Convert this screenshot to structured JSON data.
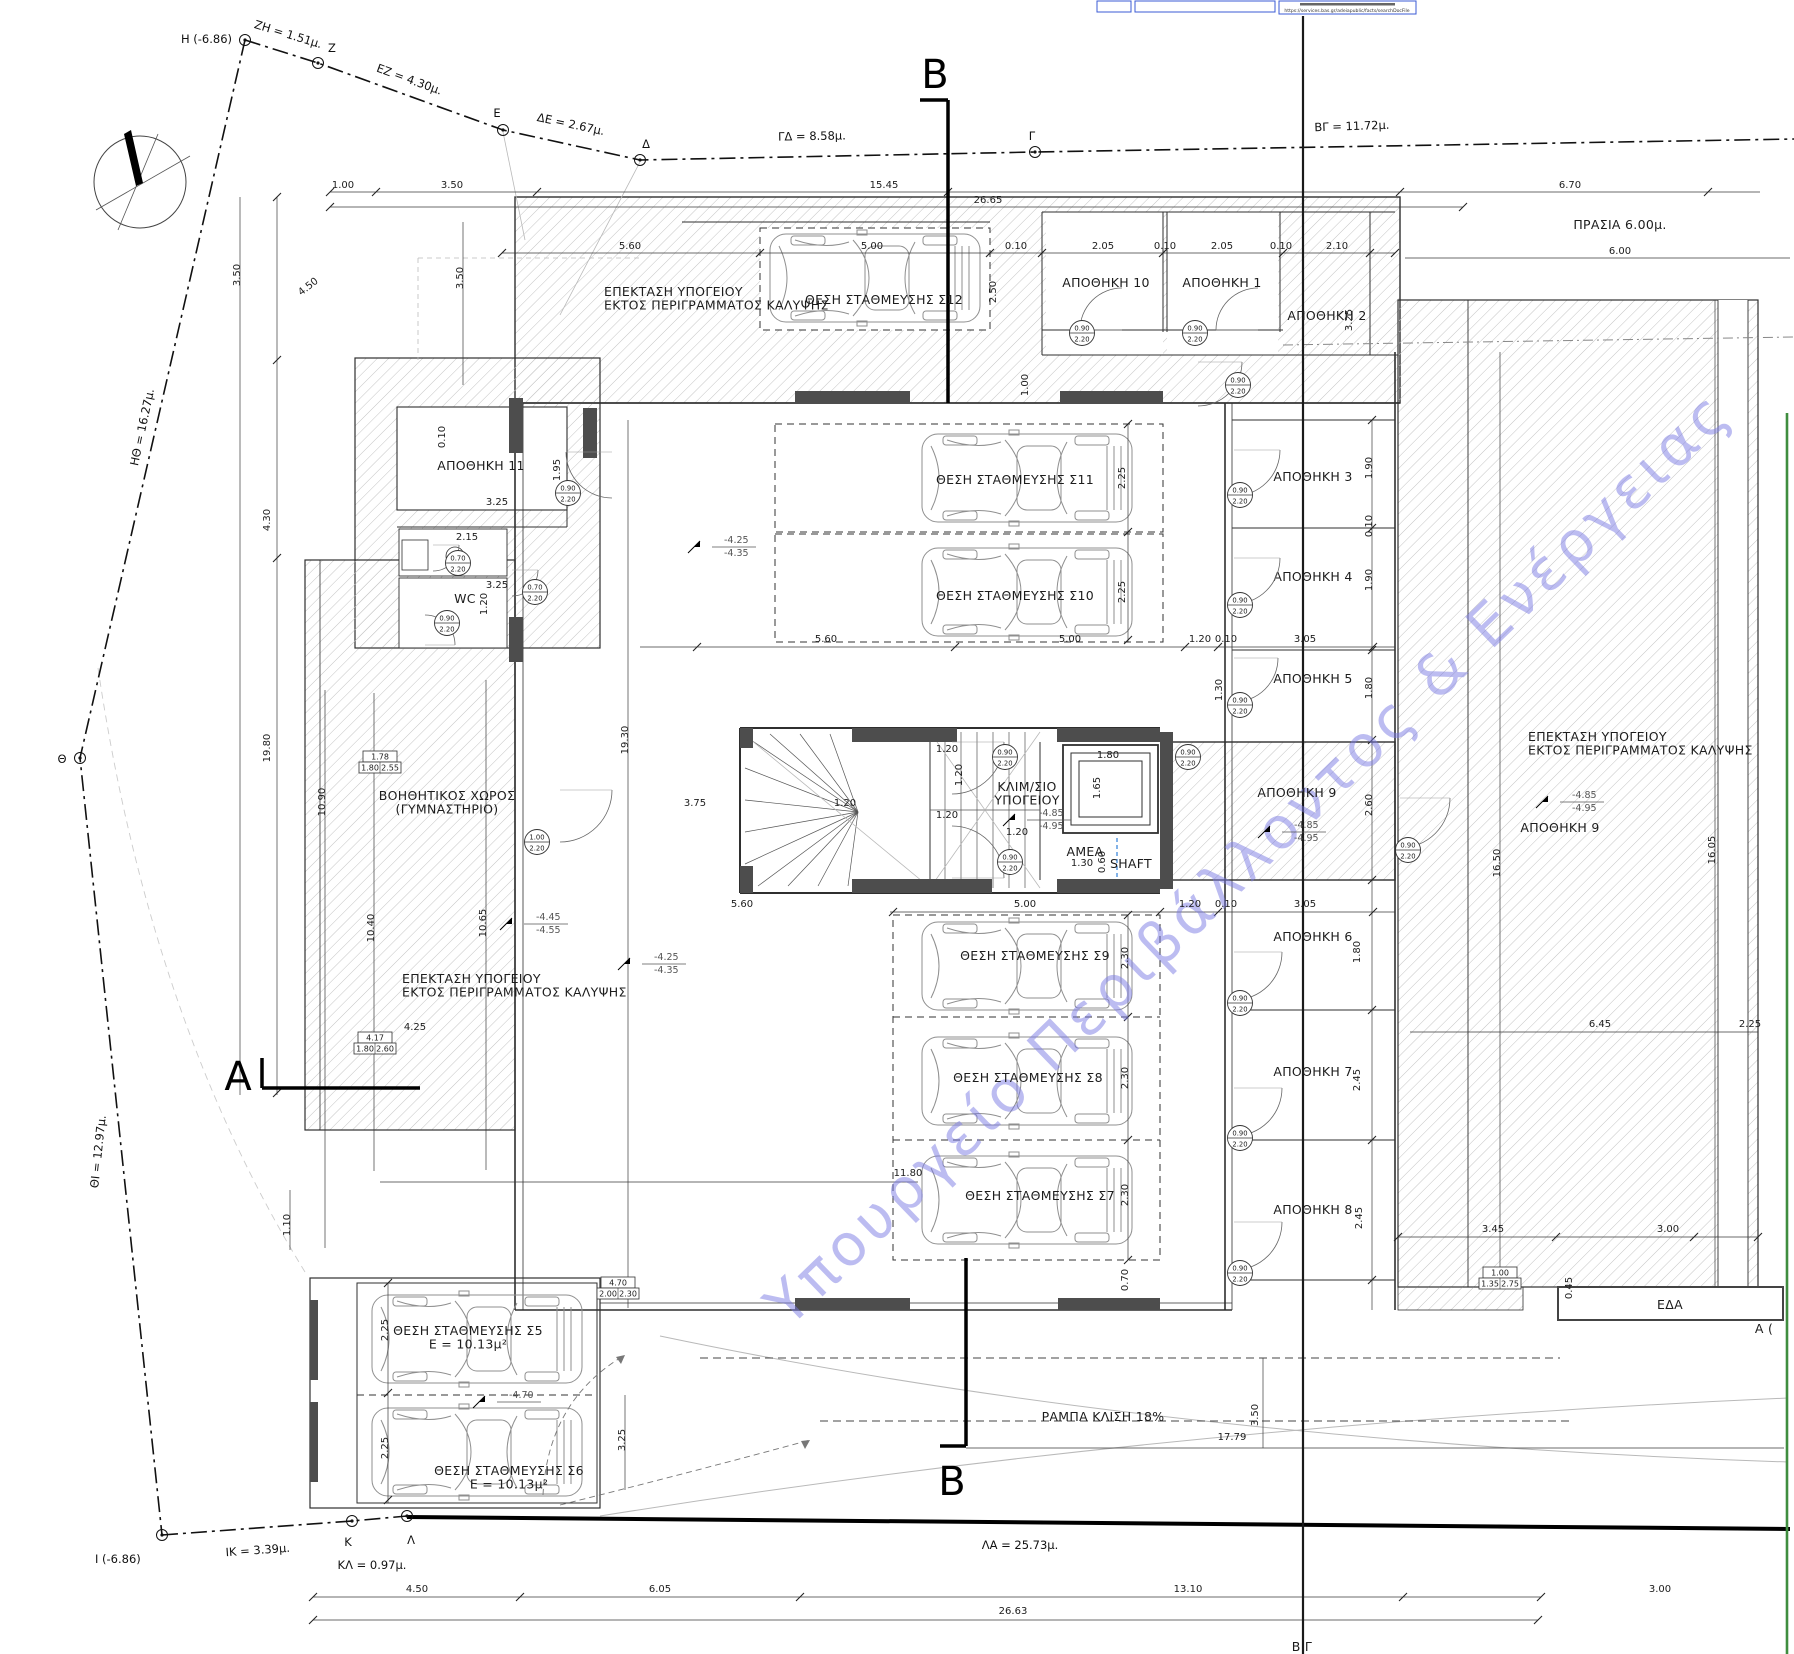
{
  "drawing": {
    "watermark": "Υπουργείο Περιβάλλοντος & Ενέργειας",
    "stamp_url": "https://services.bas.gr/adeiapublic/facts/searchDocFile",
    "accent_blue": "#2e7fd9",
    "green_line_color": "#3f8d3f"
  },
  "boundary": {
    "points": [
      {
        "label": "H (-6.86)",
        "x": 245,
        "y": 40,
        "lx": 232,
        "ly": 43,
        "anchor": "end"
      },
      {
        "label": "Z",
        "x": 318,
        "y": 63,
        "lx": 328,
        "ly": 52,
        "anchor": "start"
      },
      {
        "label": "E",
        "x": 503,
        "y": 130,
        "lx": 497,
        "ly": 117,
        "anchor": "middle"
      },
      {
        "label": "Δ",
        "x": 640,
        "y": 160,
        "lx": 646,
        "ly": 148,
        "anchor": "middle"
      },
      {
        "label": "Γ",
        "x": 1035,
        "y": 152,
        "lx": 1032,
        "ly": 140,
        "anchor": "middle"
      },
      {
        "label": "Θ",
        "x": 80,
        "y": 758,
        "lx": 62,
        "ly": 763,
        "anchor": "middle"
      },
      {
        "label": "Ι (-6.86)",
        "x": 162,
        "y": 1535,
        "lx": 95,
        "ly": 1563,
        "anchor": "start"
      },
      {
        "label": "Κ",
        "x": 352,
        "y": 1521,
        "lx": 348,
        "ly": 1546,
        "anchor": "middle"
      },
      {
        "label": "Λ",
        "x": 407,
        "y": 1516,
        "lx": 411,
        "ly": 1544,
        "anchor": "middle"
      }
    ],
    "segments": [
      {
        "label": "ZH = 1.51μ.",
        "x": 287,
        "y": 38,
        "rot": 17
      },
      {
        "label": "EZ = 4.30μ.",
        "x": 408,
        "y": 83,
        "rot": 20
      },
      {
        "label": "ΔΕ = 2.67μ.",
        "x": 570,
        "y": 128,
        "rot": 12
      },
      {
        "label": "ΓΔ = 8.58μ.",
        "x": 812,
        "y": 140,
        "rot": -1
      },
      {
        "label": "ΒΓ = 11.72μ.",
        "x": 1352,
        "y": 130,
        "rot": -2
      },
      {
        "label": "ΗΘ = 16.27μ.",
        "x": 146,
        "y": 428,
        "rot": -78
      },
      {
        "label": "ΘΙ = 12.97μ.",
        "x": 102,
        "y": 1152,
        "rot": -84
      },
      {
        "label": "ΙΚ = 3.39μ.",
        "x": 258,
        "y": 1554,
        "rot": -4
      },
      {
        "label": "ΚΛ = 0.97μ.",
        "x": 372,
        "y": 1569,
        "rot": 0
      },
      {
        "label": "ΛΑ = 25.73μ.",
        "x": 1020,
        "y": 1549,
        "rot": 0
      }
    ]
  },
  "sections": [
    {
      "letter": "Β",
      "x": 935,
      "y": 88,
      "size": 40
    },
    {
      "letter": "Β",
      "x": 952,
      "y": 1495,
      "size": 40
    },
    {
      "letter": "Α",
      "x": 238,
      "y": 1090,
      "size": 38
    }
  ],
  "room_labels": [
    {
      "id": "epektasi-top",
      "lines": [
        "ΕΠΕΚΤΑΣΗ ΥΠΟΓΕΙΟΥ",
        "ΕΚΤΟΣ ΠΕΡΙΓΡΑΜΜΑΤΟΣ ΚΑΛΥΨΗΣ"
      ],
      "x": 604,
      "y": 296,
      "align": "start"
    },
    {
      "id": "parking-s12",
      "lines": [
        "ΘΕΣΗ ΣΤΑΘΜΕΥΣΗΣ Σ12"
      ],
      "x": 884,
      "y": 304
    },
    {
      "id": "apothiki-10",
      "lines": [
        "ΑΠΟΘΗΚΗ 10"
      ],
      "x": 1106,
      "y": 287
    },
    {
      "id": "apothiki-1",
      "lines": [
        "ΑΠΟΘΗΚΗ 1"
      ],
      "x": 1222,
      "y": 287
    },
    {
      "id": "apothiki-2",
      "lines": [
        "ΑΠΟΘΗΚΗ 2"
      ],
      "x": 1327,
      "y": 320
    },
    {
      "id": "apothiki-11",
      "lines": [
        "ΑΠΟΘΗΚΗ 11"
      ],
      "x": 481,
      "y": 470
    },
    {
      "id": "wc",
      "lines": [
        "WC"
      ],
      "x": 465,
      "y": 603
    },
    {
      "id": "parking-s11",
      "lines": [
        "ΘΕΣΗ ΣΤΑΘΜΕΥΣΗΣ Σ11"
      ],
      "x": 1015,
      "y": 484
    },
    {
      "id": "parking-s10",
      "lines": [
        "ΘΕΣΗ ΣΤΑΘΜΕΥΣΗΣ Σ10"
      ],
      "x": 1015,
      "y": 600
    },
    {
      "id": "apothiki-3",
      "lines": [
        "ΑΠΟΘΗΚΗ 3"
      ],
      "x": 1313,
      "y": 481
    },
    {
      "id": "apothiki-4",
      "lines": [
        "ΑΠΟΘΗΚΗ 4"
      ],
      "x": 1313,
      "y": 581
    },
    {
      "id": "apothiki-5",
      "lines": [
        "ΑΠΟΘΗΚΗ 5"
      ],
      "x": 1313,
      "y": 683
    },
    {
      "id": "klimakostasio",
      "lines": [
        "ΚΛΙΜ/ΣΙΟ",
        "ΥΠΟΓΕΙΟΥ"
      ],
      "x": 1027,
      "y": 791
    },
    {
      "id": "amea",
      "lines": [
        "ΑΜΕΑ"
      ],
      "x": 1085,
      "y": 856,
      "size": 15,
      "color": "#2e7fd9"
    },
    {
      "id": "shaft",
      "lines": [
        "SHAFT"
      ],
      "x": 1131,
      "y": 868
    },
    {
      "id": "apothiki-9-core",
      "lines": [
        "ΑΠΟΘΗΚΗ 9"
      ],
      "x": 1297,
      "y": 797
    },
    {
      "id": "gym",
      "lines": [
        "ΒΟΗΘΗΤΙΚΟΣ ΧΩΡΟΣ",
        "(ΓΥΜΝΑΣΤΗΡΙΟ)"
      ],
      "x": 447,
      "y": 800
    },
    {
      "id": "epektasi-left",
      "lines": [
        "ΕΠΕΚΤΑΣΗ ΥΠΟΓΕΙΟΥ",
        "ΕΚΤΟΣ ΠΕΡΙΓΡΑΜΜΑΤΟΣ ΚΑΛΥΨΗΣ"
      ],
      "x": 402,
      "y": 983,
      "align": "start"
    },
    {
      "id": "parking-s9",
      "lines": [
        "ΘΕΣΗ ΣΤΑΘΜΕΥΣΗΣ Σ9"
      ],
      "x": 1035,
      "y": 960
    },
    {
      "id": "parking-s8",
      "lines": [
        "ΘΕΣΗ ΣΤΑΘΜΕΥΣΗΣ Σ8"
      ],
      "x": 1028,
      "y": 1082
    },
    {
      "id": "parking-s7",
      "lines": [
        "ΘΕΣΗ ΣΤΑΘΜΕΥΣΗΣ Σ7"
      ],
      "x": 1040,
      "y": 1200
    },
    {
      "id": "apothiki-6",
      "lines": [
        "ΑΠΟΘΗΚΗ 6"
      ],
      "x": 1313,
      "y": 941
    },
    {
      "id": "apothiki-7",
      "lines": [
        "ΑΠΟΘΗΚΗ 7"
      ],
      "x": 1313,
      "y": 1076
    },
    {
      "id": "apothiki-8",
      "lines": [
        "ΑΠΟΘΗΚΗ 8"
      ],
      "x": 1313,
      "y": 1214
    },
    {
      "id": "epektasi-right",
      "lines": [
        "ΕΠΕΚΤΑΣΗ ΥΠΟΓΕΙΟΥ",
        "ΕΚΤΟΣ ΠΕΡΙΓΡΑΜΜΑΤΟΣ ΚΑΛΥΨΗΣ"
      ],
      "x": 1528,
      "y": 741,
      "align": "start"
    },
    {
      "id": "apothiki-9-right",
      "lines": [
        "ΑΠΟΘΗΚΗ 9"
      ],
      "x": 1560,
      "y": 832
    },
    {
      "id": "parking-s5",
      "lines": [
        "ΘΕΣΗ ΣΤΑΘΜΕΥΣΗΣ Σ5",
        "Ε = 10.13μ²"
      ],
      "x": 468,
      "y": 1335
    },
    {
      "id": "parking-s6",
      "lines": [
        "ΘΕΣΗ ΣΤΑΘΜΕΥΣΗΣ Σ6",
        "Ε = 10.13μ²"
      ],
      "x": 509,
      "y": 1475
    },
    {
      "id": "rampa",
      "lines": [
        "ΡΑΜΠΑ ΚΛΙΣΗ 18%"
      ],
      "x": 1103,
      "y": 1421,
      "size": 14
    },
    {
      "id": "prasia",
      "lines": [
        "ΠΡΑΣΙΑ 6.00μ."
      ],
      "x": 1620,
      "y": 229,
      "size": 13
    },
    {
      "id": "eda",
      "lines": [
        "ΕΔΑ"
      ],
      "x": 1670,
      "y": 1309
    },
    {
      "id": "label-bg-partial",
      "lines": [
        "Β Γ"
      ],
      "x": 1302,
      "y": 1651,
      "size": 17
    },
    {
      "id": "label-a-partial",
      "lines": [
        "Α ("
      ],
      "x": 1764,
      "y": 1333,
      "size": 11
    }
  ],
  "levels": [
    {
      "x": 720,
      "y": 545,
      "top": "-4.25",
      "bot": "-4.35"
    },
    {
      "x": 650,
      "y": 962,
      "top": "-4.25",
      "bot": "-4.35"
    },
    {
      "x": 1035,
      "y": 818,
      "top": "-4.85",
      "bot": "-4.95"
    },
    {
      "x": 1290,
      "y": 830,
      "top": "-4.85",
      "bot": "-4.95"
    },
    {
      "x": 1568,
      "y": 800,
      "top": "-4.85",
      "bot": "-4.95"
    },
    {
      "x": 532,
      "y": 922,
      "top": "-4.45",
      "bot": "-4.55"
    },
    {
      "x": 505,
      "y": 1400,
      "top": "-4.70",
      "bot": ""
    }
  ],
  "dims": [
    {
      "t": "1.00",
      "x": 343,
      "y": 188
    },
    {
      "t": "3.50",
      "x": 452,
      "y": 188
    },
    {
      "t": "15.45",
      "x": 884,
      "y": 188
    },
    {
      "t": "26.65",
      "x": 988,
      "y": 203
    },
    {
      "t": "6.70",
      "x": 1570,
      "y": 188
    },
    {
      "t": "6.00",
      "x": 1620,
      "y": 254
    },
    {
      "t": "5.60",
      "x": 630,
      "y": 249
    },
    {
      "t": "5.00",
      "x": 872,
      "y": 249
    },
    {
      "t": "0.10",
      "x": 1016,
      "y": 249
    },
    {
      "t": "2.05",
      "x": 1103,
      "y": 249
    },
    {
      "t": "0.10",
      "x": 1165,
      "y": 249
    },
    {
      "t": "2.05",
      "x": 1222,
      "y": 249
    },
    {
      "t": "0.10",
      "x": 1281,
      "y": 249
    },
    {
      "t": "2.10",
      "x": 1337,
      "y": 249
    },
    {
      "t": "2.50",
      "x": 996,
      "y": 292,
      "rot": -90
    },
    {
      "t": "3.25",
      "x": 1352,
      "y": 320,
      "rot": -90
    },
    {
      "t": "1.00",
      "x": 1028,
      "y": 385,
      "rot": -90
    },
    {
      "t": "1.95",
      "x": 560,
      "y": 470,
      "rot": -90
    },
    {
      "t": "3.50",
      "x": 463,
      "y": 278,
      "rot": -90
    },
    {
      "t": "4.50",
      "x": 310,
      "y": 289,
      "rot": -38
    },
    {
      "t": "3.50",
      "x": 240,
      "y": 275,
      "rot": -90
    },
    {
      "t": "4.30",
      "x": 270,
      "y": 520,
      "rot": -90
    },
    {
      "t": "19.80",
      "x": 270,
      "y": 748,
      "rot": -90
    },
    {
      "t": "10.90",
      "x": 325,
      "y": 802,
      "rot": -90
    },
    {
      "t": "10.40",
      "x": 374,
      "y": 928,
      "rot": -90
    },
    {
      "t": "10.65",
      "x": 486,
      "y": 923,
      "rot": -90
    },
    {
      "t": "19.30",
      "x": 628,
      "y": 740,
      "rot": -90
    },
    {
      "t": "1.10",
      "x": 290,
      "y": 1225,
      "rot": -90
    },
    {
      "t": "4.25",
      "x": 415,
      "y": 1030
    },
    {
      "t": "3.25",
      "x": 497,
      "y": 505
    },
    {
      "t": "2.15",
      "x": 467,
      "y": 540
    },
    {
      "t": "3.25",
      "x": 497,
      "y": 588
    },
    {
      "t": "1.20",
      "x": 487,
      "y": 604,
      "rot": -90
    },
    {
      "t": "0.10",
      "x": 445,
      "y": 437,
      "rot": -90
    },
    {
      "t": "5.60",
      "x": 826,
      "y": 642
    },
    {
      "t": "5.00",
      "x": 1070,
      "y": 642
    },
    {
      "t": "1.20",
      "x": 1200,
      "y": 642
    },
    {
      "t": "0.10",
      "x": 1226,
      "y": 642
    },
    {
      "t": "3.05",
      "x": 1305,
      "y": 642
    },
    {
      "t": "2.25",
      "x": 1125,
      "y": 478,
      "rot": -90
    },
    {
      "t": "2.25",
      "x": 1125,
      "y": 592,
      "rot": -90
    },
    {
      "t": "1.30",
      "x": 1222,
      "y": 690,
      "rot": -90
    },
    {
      "t": "3.75",
      "x": 695,
      "y": 806
    },
    {
      "t": "1.20",
      "x": 947,
      "y": 752
    },
    {
      "t": "1.20",
      "x": 962,
      "y": 775,
      "rot": -90
    },
    {
      "t": "1.20",
      "x": 947,
      "y": 818
    },
    {
      "t": "1.20",
      "x": 845,
      "y": 806
    },
    {
      "t": "1.20",
      "x": 1017,
      "y": 835
    },
    {
      "t": "1.80",
      "x": 1108,
      "y": 758
    },
    {
      "t": "1.65",
      "x": 1100,
      "y": 788,
      "rot": -90
    },
    {
      "t": "1.30",
      "x": 1082,
      "y": 866
    },
    {
      "t": "0.60",
      "x": 1105,
      "y": 862,
      "rot": -90
    },
    {
      "t": "1.90",
      "x": 1372,
      "y": 468,
      "rot": -90
    },
    {
      "t": "0.10",
      "x": 1372,
      "y": 526,
      "rot": -90
    },
    {
      "t": "1.90",
      "x": 1372,
      "y": 580,
      "rot": -90
    },
    {
      "t": "1.80",
      "x": 1372,
      "y": 688,
      "rot": -90
    },
    {
      "t": "2.60",
      "x": 1372,
      "y": 805,
      "rot": -90
    },
    {
      "t": "1.80",
      "x": 1360,
      "y": 952,
      "rot": -90
    },
    {
      "t": "2.45",
      "x": 1360,
      "y": 1080,
      "rot": -90
    },
    {
      "t": "2.45",
      "x": 1362,
      "y": 1218,
      "rot": -90
    },
    {
      "t": "5.60",
      "x": 742,
      "y": 907
    },
    {
      "t": "5.00",
      "x": 1025,
      "y": 907
    },
    {
      "t": "1.20",
      "x": 1190,
      "y": 907
    },
    {
      "t": "0.10",
      "x": 1226,
      "y": 907
    },
    {
      "t": "3.05",
      "x": 1305,
      "y": 907
    },
    {
      "t": "2.30",
      "x": 1128,
      "y": 958,
      "rot": -90
    },
    {
      "t": "2.30",
      "x": 1128,
      "y": 1078,
      "rot": -90
    },
    {
      "t": "2.30",
      "x": 1128,
      "y": 1195,
      "rot": -90
    },
    {
      "t": "11.80",
      "x": 908,
      "y": 1176
    },
    {
      "t": "0.70",
      "x": 1128,
      "y": 1280,
      "rot": -90
    },
    {
      "t": "16.50",
      "x": 1500,
      "y": 863,
      "rot": -90
    },
    {
      "t": "16.05",
      "x": 1715,
      "y": 850,
      "rot": -90
    },
    {
      "t": "6.45",
      "x": 1600,
      "y": 1027
    },
    {
      "t": "2.25",
      "x": 1750,
      "y": 1027
    },
    {
      "t": "3.45",
      "x": 1493,
      "y": 1232
    },
    {
      "t": "3.00",
      "x": 1668,
      "y": 1232
    },
    {
      "t": "0.45",
      "x": 1572,
      "y": 1288,
      "rot": -90
    },
    {
      "t": "2.25",
      "x": 388,
      "y": 1330,
      "rot": -90
    },
    {
      "t": "2.25",
      "x": 388,
      "y": 1448,
      "rot": -90
    },
    {
      "t": "3.25",
      "x": 625,
      "y": 1440,
      "rot": -90
    },
    {
      "t": "17.79",
      "x": 1232,
      "y": 1440
    },
    {
      "t": "3.50",
      "x": 1258,
      "y": 1415,
      "rot": -90
    },
    {
      "t": "4.50",
      "x": 417,
      "y": 1592
    },
    {
      "t": "6.05",
      "x": 660,
      "y": 1592
    },
    {
      "t": "13.10",
      "x": 1188,
      "y": 1592
    },
    {
      "t": "3.00",
      "x": 1660,
      "y": 1592
    },
    {
      "t": "26.63",
      "x": 1013,
      "y": 1614
    }
  ],
  "door_tags": [
    {
      "x": 1082,
      "y": 333,
      "w": "0.90",
      "h": "2.20",
      "arc": [
        1122,
        330,
        42,
        2
      ]
    },
    {
      "x": 1195,
      "y": 333,
      "w": "0.90",
      "h": "2.20",
      "arc": [
        1258,
        330,
        42,
        2
      ]
    },
    {
      "x": 1238,
      "y": 385,
      "w": "0.90",
      "h": "2.20",
      "arc": [
        1198,
        362,
        44,
        4
      ]
    },
    {
      "x": 568,
      "y": 493,
      "w": "0.90",
      "h": "2.20",
      "arc": [
        612,
        452,
        46,
        3
      ]
    },
    {
      "x": 458,
      "y": 563,
      "w": "0.70",
      "h": "2.20",
      "arc": [
        433,
        545,
        26,
        4
      ]
    },
    {
      "x": 535,
      "y": 592,
      "w": "0.70",
      "h": "2.20",
      "arc": [
        512,
        570,
        26,
        4
      ]
    },
    {
      "x": 447,
      "y": 623,
      "w": "0.90",
      "h": "2.20",
      "arc": [
        425,
        645,
        30,
        1
      ]
    },
    {
      "x": 537,
      "y": 842,
      "w": "1.00",
      "h": "2.20",
      "arc": [
        560,
        790,
        52,
        4
      ]
    },
    {
      "x": 1005,
      "y": 757,
      "w": "0.90",
      "h": "2.20",
      "arc": [
        952,
        742,
        52,
        4
      ]
    },
    {
      "x": 1010,
      "y": 862,
      "w": "0.90",
      "h": "2.20",
      "arc": [
        952,
        878,
        52,
        1
      ]
    },
    {
      "x": 1240,
      "y": 495,
      "w": "0.90",
      "h": "2.20",
      "arc": [
        1234,
        450,
        46,
        4
      ]
    },
    {
      "x": 1240,
      "y": 605,
      "w": "0.90",
      "h": "2.20",
      "arc": [
        1234,
        558,
        46,
        4
      ]
    },
    {
      "x": 1240,
      "y": 705,
      "w": "0.90",
      "h": "2.20",
      "arc": [
        1234,
        658,
        44,
        4
      ]
    },
    {
      "x": 1188,
      "y": 757,
      "w": "0.90",
      "h": "2.20"
    },
    {
      "x": 1240,
      "y": 1003,
      "w": "0.90",
      "h": "2.20",
      "arc": [
        1234,
        952,
        48,
        4
      ]
    },
    {
      "x": 1240,
      "y": 1138,
      "w": "0.90",
      "h": "2.20",
      "arc": [
        1234,
        1088,
        48,
        4
      ]
    },
    {
      "x": 1240,
      "y": 1273,
      "w": "0.90",
      "h": "2.20",
      "arc": [
        1234,
        1222,
        48,
        4
      ]
    },
    {
      "x": 1408,
      "y": 850,
      "w": "0.90",
      "h": "2.20",
      "arc": [
        1400,
        798,
        50,
        4
      ]
    }
  ],
  "window_tags": [
    {
      "x": 380,
      "y": 762,
      "a": "1.78",
      "b": "1.80",
      "c": "2.55"
    },
    {
      "x": 375,
      "y": 1043,
      "a": "4.17",
      "b": "1.80",
      "c": "2.60"
    },
    {
      "x": 618,
      "y": 1288,
      "a": "4.70",
      "b": "2.00",
      "c": "2.30"
    },
    {
      "x": 1500,
      "y": 1278,
      "a": "1.00",
      "b": "1.35",
      "c": "2.75"
    }
  ],
  "cars": [
    {
      "x": 875,
      "y": 278
    },
    {
      "x": 1027,
      "y": 478
    },
    {
      "x": 1027,
      "y": 592
    },
    {
      "x": 1027,
      "y": 966
    },
    {
      "x": 1027,
      "y": 1081
    },
    {
      "x": 1027,
      "y": 1200
    },
    {
      "x": 477,
      "y": 1339
    },
    {
      "x": 477,
      "y": 1452
    }
  ]
}
